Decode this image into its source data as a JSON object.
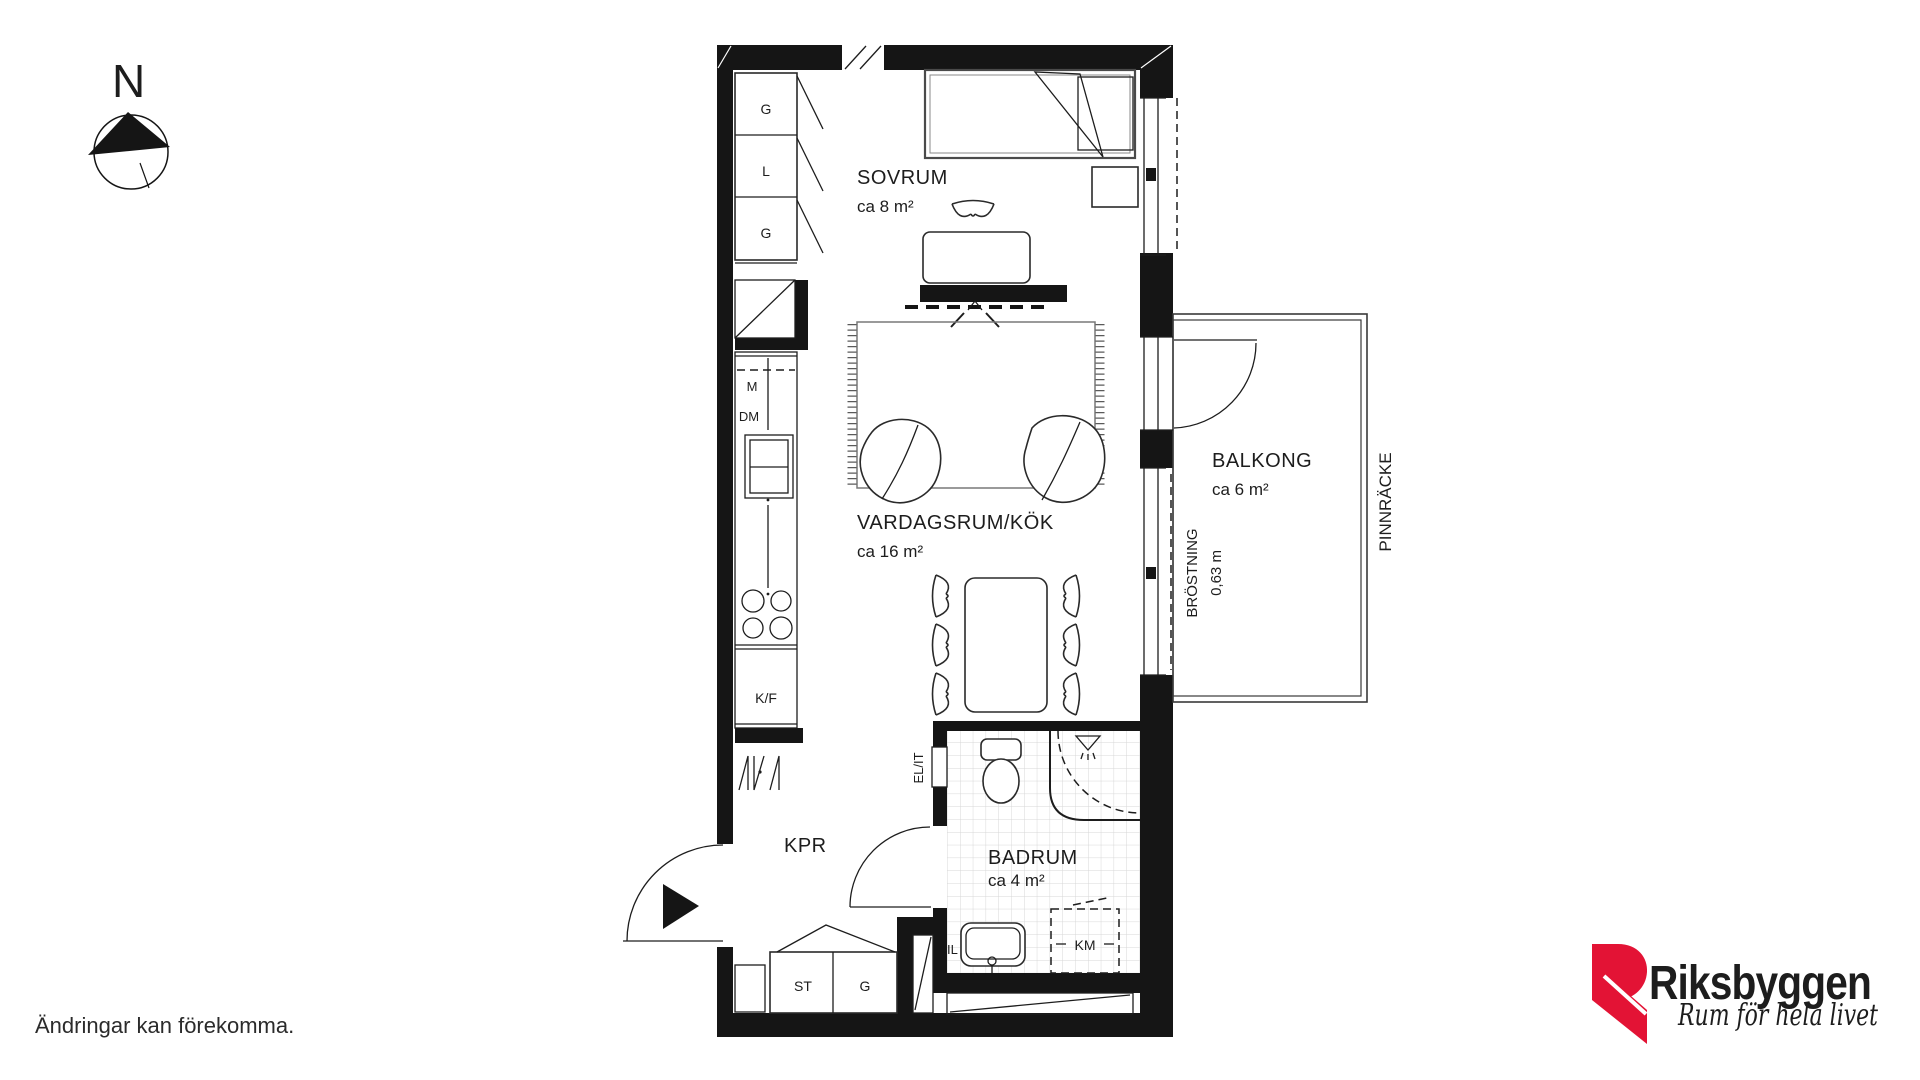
{
  "document": {
    "type": "apartment floor plan",
    "disclaimer": "Ändringar kan förekomma."
  },
  "compass": {
    "north_label": "N"
  },
  "rooms": {
    "sovrum": {
      "name": "SOVRUM",
      "area": "ca 8 m²"
    },
    "vardagsrum_kok": {
      "name": "VARDAGSRUM/KÖK",
      "area": "ca 16 m²"
    },
    "balkong": {
      "name": "BALKONG",
      "area": "ca 6 m²"
    },
    "badrum": {
      "name": "BADRUM",
      "area": "ca 4 m²"
    },
    "kapprum": {
      "name": "KPR"
    }
  },
  "fixtures": {
    "closet_top_1": "G",
    "closet_top_2": "L",
    "closet_top_3": "G",
    "microwave": "M",
    "dishwasher": "DM",
    "fridge_freezer": "K/F",
    "closet_bottom_1": "ST",
    "closet_bottom_2": "G",
    "washing_machine": "KM",
    "basin_label": "IL",
    "electrical_cabinet": "EL/IT"
  },
  "balcony": {
    "parapet_label": "BRÖSTNING",
    "parapet_height": "0,63 m",
    "railing_label": "PINNRÄCKE"
  },
  "branding": {
    "company": "Riksbyggen",
    "tagline": "Rum för hela livet",
    "brand_red": "#e31335",
    "brand_gray": "#9a9a9a"
  }
}
